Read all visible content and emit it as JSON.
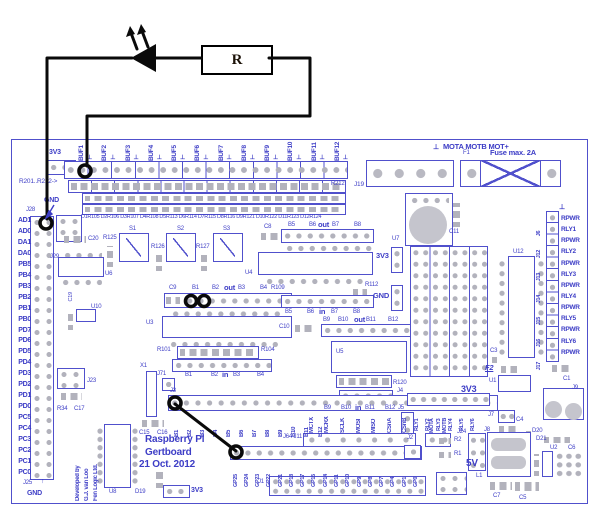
{
  "schematic": {
    "resistor_label": "R"
  },
  "symbols": {
    "gnd": "⊥",
    "arrow_up": "↑"
  },
  "board": {
    "top_left": {
      "v33": "3V3",
      "r_row": "R201..R212->",
      "gnd": "GND",
      "j28": "J28"
    },
    "buffers": [
      "BUF1",
      "BUF2",
      "BUF3",
      "BUF4",
      "BUF5",
      "BUF6",
      "BUF7",
      "BUF8",
      "BUF9",
      "BUF10",
      "BUF11",
      "BUF12"
    ],
    "dr_text": "D1R105 D2R106 D3R107 D4R108 D5R113 D6R114 D7R115 D8R116 D9R121 D10R122 D11R123 D12R124",
    "r212": "R212",
    "j19": "J19",
    "motor_header": "MOTA MOTB MOT+",
    "fuse": {
      "f1": "F1",
      "caption": "Fuse max. 2A"
    },
    "left_ports": [
      "AD1",
      "AD0",
      "DA1",
      "DA0",
      "PB5",
      "PB4",
      "PB3",
      "PB2",
      "PB1",
      "PB0",
      "PD7",
      "PD6",
      "PD5",
      "PD4",
      "PD3",
      "PD2",
      "PD1",
      "PD0",
      "PC5",
      "PC4",
      "PC3",
      "PC2",
      "PC1",
      "PC0"
    ],
    "left_bottom": {
      "j25": "J25",
      "gnd": "GND"
    },
    "groups": {
      "g1": {
        "c9": "C9",
        "b1": "B1",
        "b2": "B2",
        "out": "out",
        "b3": "B3",
        "b4": "B4",
        "r109": "R109",
        "u3": "U3",
        "r101": "R101",
        "r104": "R104",
        "ib1": "B1",
        "ib2": "B2",
        "in": "in",
        "ib3": "B3",
        "ib4": "B4"
      },
      "g2": {
        "c8": "C8",
        "b5": "B5",
        "b6": "B6",
        "out": "out",
        "b7": "B7",
        "b8": "B8",
        "u4": "U4",
        "ib5": "B5",
        "ib6": "B6",
        "in": "in",
        "ib7": "B7",
        "ib8": "B8",
        "c10": "C10"
      },
      "g3": {
        "b9": "B9",
        "b10": "B10",
        "out": "out",
        "b11": "B11",
        "b12": "B12",
        "u5": "U5",
        "r120": "R120",
        "ib9": "B9",
        "ib10": "B10",
        "in": "in",
        "ib11": "B11",
        "ib12": "B12"
      }
    },
    "j3": {
      "label": "J3",
      "pins": [
        "B1",
        "B2",
        "B3",
        "B4",
        "B5",
        "B6",
        "B7",
        "B8",
        "B9",
        "B10",
        "B11",
        "B12"
      ]
    },
    "signals": [
      "MCTX",
      "MCRX",
      "SCLK",
      "MOSI",
      "MISO",
      "CSnA",
      "CSnB"
    ],
    "motor_pins": [
      "MOTA",
      "MOTB"
    ],
    "gpio": {
      "label": "J64 J11",
      "j2": "J2",
      "pins": [
        "GP25",
        "GP24",
        "GP23",
        "GP22",
        "GP21",
        "GP18",
        "GP17",
        "GP15",
        "GP14",
        "GP11",
        "GP10",
        "GP9",
        "GP8",
        "GP7",
        "GP4",
        "GP1",
        "GP0"
      ]
    },
    "j4": {
      "label": "J4",
      "relays": [
        "RLY1",
        "RLY2",
        "RLY3",
        "RLY4",
        "RLY5",
        "RLY6"
      ]
    },
    "j5": "J5",
    "j1": "J1",
    "relay_col": {
      "labels": [
        "RPWR",
        "RLY1",
        "RPWR",
        "RLY2",
        "RPWR",
        "RLY3",
        "RPWR",
        "RLY4",
        "RPWR",
        "RLY5",
        "RPWR",
        "RLY6",
        "RPWR"
      ],
      "headers": [
        "J6",
        "J12",
        "J13",
        "J14",
        "J15",
        "J16",
        "J17"
      ]
    },
    "title": {
      "l1": "Raspberry Pi",
      "l2": "Gertboard",
      "l3": "21 Oct. 2012"
    },
    "credit": {
      "l1": "Developed by",
      "l2": "G.J. van Loo",
      "l3": "Fen Logic Ltd."
    },
    "parts": {
      "c20": "C20",
      "j29": "J29",
      "u6": "U6",
      "r125": "R125",
      "s1": "S1",
      "s2": "S2",
      "s3": "S3",
      "r126": "R126",
      "r127": "R127",
      "c19": "C19",
      "u10": "U10",
      "x1": "X1",
      "j71": "J71",
      "u7": "U7",
      "c11": "C11",
      "v33_a": "3V3",
      "gnd_a": "GND",
      "r112": "R112",
      "u12": "U12",
      "c3": "C3",
      "f2": "F2",
      "u1": "U1",
      "c1": "C1",
      "j9": "J9",
      "j7": "J7",
      "c4": "C4",
      "j8": "J8",
      "d20": "D20",
      "d21": "D21",
      "u2": "U2",
      "c6": "C6",
      "j24": "J24",
      "r2": "R2",
      "r1": "R1",
      "v5": "5V",
      "l1": "L1",
      "c7": "C7",
      "c5": "C5",
      "u8": "U8",
      "d19": "D19",
      "c15": "C15",
      "c16": "C16",
      "v33_b": "3V3",
      "v33_c": "3V3",
      "j23": "J23",
      "r34": "R34",
      "c17": "C17"
    }
  }
}
